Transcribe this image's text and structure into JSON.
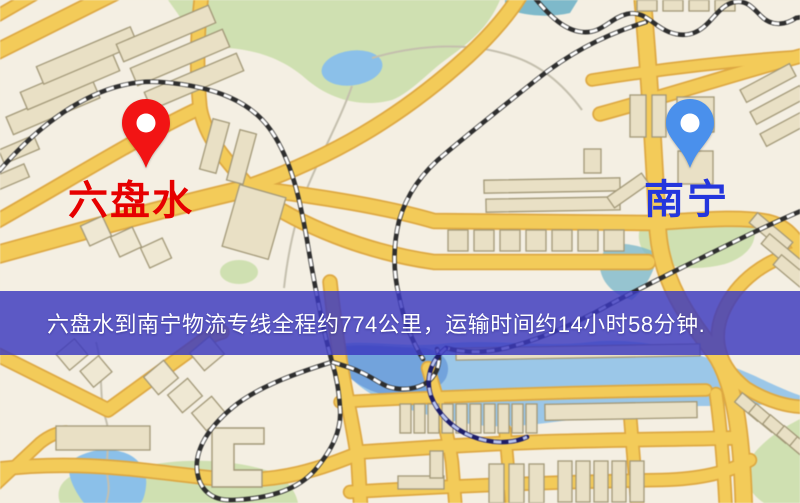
{
  "banner": {
    "text": "六盘水到南宁物流专线全程约774公里，运输时间约14小时58分钟.",
    "background_rgba": "rgba(58,56,190,0.82)",
    "text_color": "#ffffff"
  },
  "route": {
    "origin": "六盘水",
    "destination": "南宁",
    "distance_text": "约774公里",
    "duration_text": "约14小时58分钟"
  },
  "map": {
    "origin_label": {
      "text": "六盘水",
      "color": "#e60000"
    },
    "destination_label": {
      "text": "南宁",
      "color": "#2436dd"
    },
    "markers": {
      "origin": {
        "name": "red-pin",
        "color": "#f21414"
      },
      "destination": {
        "name": "blue-pin",
        "color": "#4a90ec"
      }
    },
    "palette": {
      "bg": "#f4efe3",
      "road": "#f2cb5c",
      "roadCasing": "#dca845",
      "building": "#e9e0c6",
      "buildingLight": "#efe8d4",
      "buildingStroke": "#a29879",
      "park": "#cfe0b2",
      "water": "#8cc0e8",
      "waterDeep": "#6f9fd8",
      "waterTeal": "#7fb9c9",
      "rail": "#2e2e2e",
      "railDash": "#ffffff",
      "railNavyBase": "#1d1d66",
      "railNavyDash": "#b9c5f0",
      "trail": "#c4bfae"
    },
    "features": {
      "parks": [
        "M168,0 L500,0 C488,28 470,42 448,58 C428,72 412,92 392,100 C362,108 330,100 305,78 C282,58 255,50 228,48 C205,46 190,34 178,14 Z",
        "M645,218 C680,210 725,210 752,218 C760,238 752,255 725,264 C695,272 660,268 644,252 C636,240 638,228 645,218 Z",
        "M802,418 C782,428 760,442 748,462 C742,478 748,492 764,503 L802,503 Z",
        "M140,467 C180,458 230,458 272,472 C288,480 296,492 298,503 L60,503 C56,492 60,480 76,474 C96,468 118,470 140,467 Z",
        "M220,272 a19,12 0 1 0 38,0 a19,12 0 1 0 -38,0 Z"
      ],
      "water": [
        {
          "d": "M322,68 a30,17 -8 1 0 60,0 a30,17 -8 1 0 -60,0 Z",
          "tone": "water"
        },
        {
          "d": "M505,0 L578,0 L570,13 C548,18 522,16 505,8 Z",
          "tone": "waterTeal"
        },
        {
          "d": "M330,346 C360,338 400,348 440,344 C490,338 540,348 590,342 C640,336 700,352 755,376 C780,388 795,394 802,396 L802,404 C770,404 730,406 700,406 C660,408 620,414 585,418 C545,423 505,430 470,424 C435,418 400,408 375,396 C355,386 338,366 330,346 Z",
          "tone": "water",
          "o": 0.85
        },
        {
          "d": "M332,348 C360,342 395,348 425,348 C445,352 452,364 446,378 C438,392 415,398 392,396 C368,393 348,380 338,364 Z",
          "tone": "waterDeep",
          "o": 0.9
        },
        {
          "d": "M70,462 C82,452 104,446 122,452 C138,456 148,470 146,486 C145,496 142,503 140,503 L84,503 C74,490 66,474 70,462 Z",
          "tone": "water"
        },
        {
          "d": "M610,244 C628,242 648,248 658,254 C654,272 646,288 632,300 C616,296 602,284 600,268 C600,258 604,248 610,244 Z",
          "tone": "waterTeal",
          "o": 0.8
        }
      ],
      "trails": [
        "M352,86 C340,120 322,152 308,186 C296,216 288,252 284,288",
        "M372,58 C420,44 472,42 512,56 C544,66 566,88 582,110",
        "M96,342 C104,370 98,396 106,420 C112,440 104,460 108,480 C110,492 107,500 105,506"
      ],
      "roads": [
        {
          "d": "M-8,54 L120,-10",
          "w": 14
        },
        {
          "d": "M-10,20 L42,-10",
          "w": 10
        },
        {
          "d": "M-8,256 C80,232 170,206 250,188",
          "w": 16
        },
        {
          "d": "M202,-8 C196,40 197,78 200,108 C206,140 228,162 250,188",
          "w": 12
        },
        {
          "d": "M-8,224 C70,180 140,136 200,108",
          "w": 12
        },
        {
          "d": "M250,188 C320,196 390,208 434,221 L652,223 C700,220 740,216 768,222 C785,226 796,238 802,252",
          "w": 13
        },
        {
          "d": "M252,192 C300,226 365,252 434,262 L648,262",
          "w": 13
        },
        {
          "d": "M642,-8 C650,80 654,160 658,232 C662,282 688,318 714,352 C734,380 742,430 744,512",
          "w": 15
        },
        {
          "d": "M600,114 C680,92 740,72 808,54",
          "w": 12
        },
        {
          "d": "M592,80 C668,68 740,60 806,56",
          "w": 10
        },
        {
          "d": "M250,186 C330,158 400,118 468,56 C492,34 512,10 522,-8",
          "w": 13
        },
        {
          "d": "M802,252 C766,258 736,282 723,312 C712,338 718,366 746,388 C768,402 790,407 806,407",
          "w": 11
        },
        {
          "d": "M-8,352 L108,410 L196,346 C206,338 214,334 222,332",
          "w": 12
        },
        {
          "d": "M-8,470 C80,458 150,472 220,479 C280,484 322,468 362,452 L452,446 C552,440 640,440 732,438",
          "w": 12
        },
        {
          "d": "M-8,488 L40,443 C50,435 58,432 66,432",
          "w": 10
        },
        {
          "d": "M330,282 C334,320 338,342 340,360 C346,396 354,430 358,460 L361,512",
          "w": 12
        },
        {
          "d": "M428,368 C438,402 448,432 452,462 L456,512",
          "w": 11
        },
        {
          "d": "M505,430 L512,512",
          "w": 10
        },
        {
          "d": "M630,414 L638,512",
          "w": 11
        },
        {
          "d": "M716,394 C721,430 724,470 726,512",
          "w": 11
        },
        {
          "d": "M340,402 C450,396 560,392 706,390",
          "w": 10
        },
        {
          "d": "M350,492 C450,486 550,482 662,480 C702,479 730,472 750,460",
          "w": 11
        }
      ],
      "railways": [
        {
          "d": "M-10,182 C40,120 100,78 160,82 C216,86 252,102 272,132 C292,162 300,200 307,240 C313,276 321,322 332,362"
        },
        {
          "d": "M332,362 C300,372 258,386 232,408 C208,428 195,450 197,470 C199,490 212,501 233,500 C263,499 296,492 315,470 C332,450 342,430 340,408 C339,389 336,375 332,362"
        },
        {
          "d": "M332,362 C345,366 352,368 358,371 C371,376 378,383 389,387 C403,391 419,389 429,381 C439,372 441,359 437,349"
        },
        {
          "d": "M646,22 C600,36 566,56 536,80 C496,112 466,136 446,153 C421,173 406,196 399,221 C393,246 393,271 399,296 C404,321 413,343 423,359"
        },
        {
          "d": "M808,208 C760,228 720,249 681,268 C651,283 621,298 596,312 C561,330 531,342 506,348 C481,354 461,352 446,348"
        },
        {
          "d": "M446,348 C431,360 425,378 431,396 C437,412 451,428 471,436 C491,444 512,444 527,437",
          "navy": true
        },
        {
          "d": "M530,-8 C546,12 562,30 582,32 C602,34 610,18 627,14 C645,10 653,26 669,32 C685,38 697,34 707,24 C717,14 723,4 735,2 C747,0 753,8 761,16 C771,26 784,26 796,18 L808,16"
        }
      ],
      "buildings": [
        [
          6,
          98,
          94,
          19,
          -23
        ],
        [
          20,
          72,
          100,
          19,
          -23
        ],
        [
          36,
          46,
          102,
          19,
          -23
        ],
        [
          116,
          24,
          100,
          19,
          -23
        ],
        [
          130,
          48,
          100,
          19,
          -23
        ],
        [
          144,
          72,
          100,
          19,
          -23
        ],
        [
          0,
          142,
          38,
          15,
          -23
        ],
        [
          -6,
          170,
          34,
          14,
          -23
        ],
        [
          206,
          120,
          17,
          52,
          15
        ],
        [
          233,
          131,
          17,
          52,
          15
        ],
        [
          84,
          220,
          24,
          22,
          -25,
          1
        ],
        [
          114,
          231,
          24,
          22,
          -25,
          1
        ],
        [
          144,
          242,
          24,
          22,
          -25,
          1
        ],
        [
          230,
          190,
          48,
          64,
          16
        ],
        [
          484,
          179,
          136,
          13,
          -1
        ],
        [
          486,
          198,
          134,
          13,
          -1
        ],
        [
          584,
          149,
          17,
          24,
          0
        ],
        [
          448,
          230,
          20,
          21,
          0
        ],
        [
          474,
          230,
          20,
          21,
          0
        ],
        [
          500,
          230,
          20,
          21,
          0
        ],
        [
          526,
          230,
          20,
          21,
          0
        ],
        [
          552,
          230,
          20,
          21,
          0
        ],
        [
          578,
          230,
          20,
          21,
          0
        ],
        [
          604,
          230,
          20,
          21,
          0
        ],
        [
          630,
          95,
          16,
          42,
          0
        ],
        [
          652,
          95,
          14,
          42,
          0
        ],
        [
          677,
          97,
          37,
          35,
          0
        ],
        [
          678,
          151,
          35,
          33,
          0
        ],
        [
          637,
          0,
          20,
          11,
          0
        ],
        [
          663,
          0,
          20,
          11,
          0
        ],
        [
          689,
          0,
          20,
          11,
          0
        ],
        [
          715,
          0,
          20,
          11,
          0
        ],
        [
          607,
          184,
          42,
          13,
          -35
        ],
        [
          740,
          76,
          56,
          14,
          -28
        ],
        [
          750,
          98,
          56,
          14,
          -28
        ],
        [
          760,
          120,
          56,
          14,
          -28
        ],
        [
          748,
          226,
          46,
          13,
          40
        ],
        [
          760,
          247,
          46,
          13,
          40
        ],
        [
          772,
          268,
          46,
          13,
          40
        ],
        [
          194,
          342,
          26,
          23,
          -40,
          1
        ],
        [
          148,
          366,
          26,
          23,
          -40,
          1
        ],
        [
          172,
          384,
          26,
          23,
          -40,
          1
        ],
        [
          196,
          402,
          26,
          23,
          -40,
          1
        ],
        [
          60,
          344,
          24,
          21,
          -40,
          1
        ],
        [
          84,
          361,
          24,
          21,
          -40,
          1
        ],
        [
          56,
          426,
          94,
          24,
          0
        ],
        [
          400,
          404,
          11,
          29,
          0
        ],
        [
          414,
          404,
          11,
          29,
          0
        ],
        [
          428,
          404,
          11,
          29,
          0
        ],
        [
          442,
          404,
          11,
          29,
          0
        ],
        [
          456,
          404,
          11,
          29,
          0
        ],
        [
          470,
          404,
          11,
          29,
          0
        ],
        [
          484,
          404,
          11,
          29,
          0
        ],
        [
          498,
          404,
          11,
          29,
          0
        ],
        [
          512,
          404,
          11,
          29,
          0
        ],
        [
          526,
          404,
          11,
          29,
          0
        ],
        [
          545,
          403,
          152,
          16,
          -1
        ],
        [
          456,
          346,
          244,
          12,
          -1
        ],
        [
          489,
          464,
          15,
          39,
          0
        ],
        [
          509,
          464,
          15,
          39,
          0
        ],
        [
          529,
          464,
          15,
          39,
          0
        ],
        [
          558,
          461,
          14,
          41,
          0
        ],
        [
          576,
          461,
          14,
          41,
          0
        ],
        [
          594,
          461,
          14,
          41,
          0
        ],
        [
          612,
          461,
          14,
          41,
          0
        ],
        [
          630,
          461,
          14,
          41,
          0
        ],
        [
          398,
          476,
          46,
          13,
          0
        ],
        [
          430,
          451,
          13,
          27,
          0
        ],
        [
          744,
          392,
          12,
          30,
          -50
        ],
        [
          758,
          403,
          12,
          30,
          -50
        ],
        [
          772,
          414,
          12,
          30,
          -50
        ],
        [
          786,
          425,
          12,
          30,
          -50
        ],
        [
          799,
          436,
          12,
          30,
          -50
        ]
      ],
      "polys": [
        "M212,428 h52 v16 h-30 v26 h28 v17 h-50 Z"
      ]
    }
  }
}
